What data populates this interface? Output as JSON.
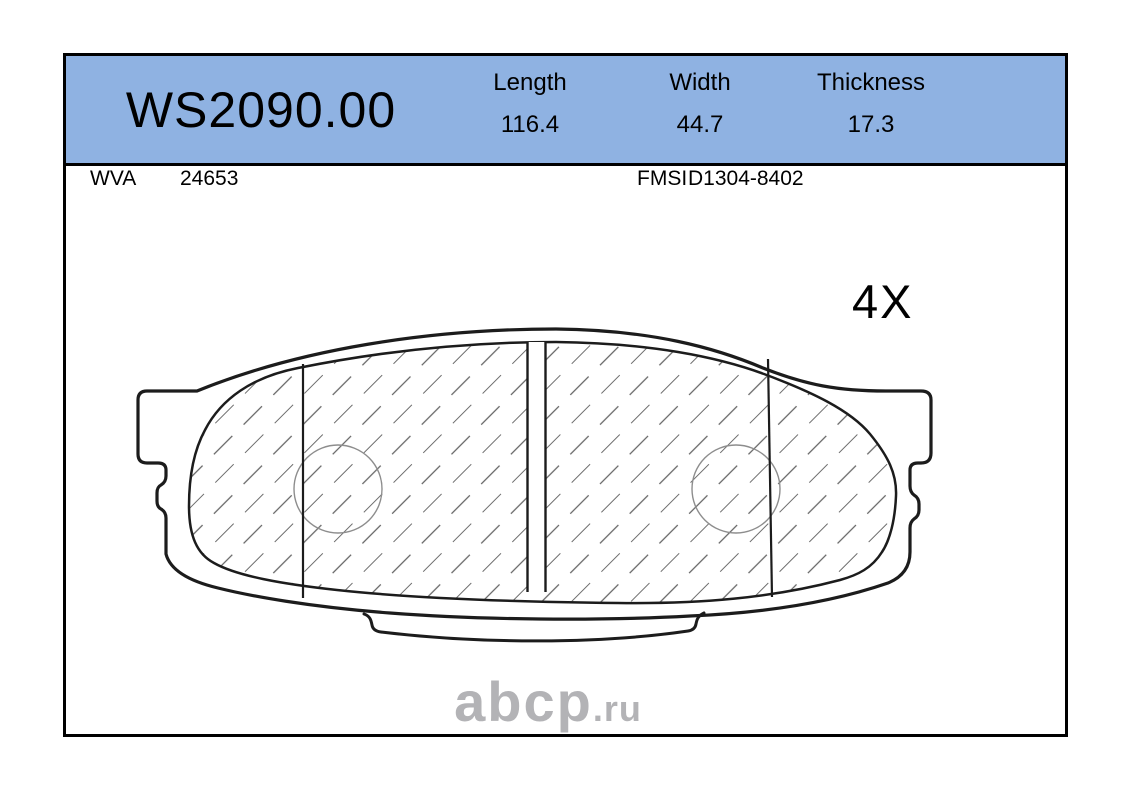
{
  "header": {
    "part_number": "WS2090.00",
    "bg_color": "#8FB2E2",
    "columns": [
      {
        "label": "Length",
        "value": "116.4"
      },
      {
        "label": "Width",
        "value": "44.7"
      },
      {
        "label": "Thickness",
        "value": "17.3"
      }
    ]
  },
  "subheader": {
    "wva": {
      "label": "WVA",
      "value": "24653"
    },
    "fmsi": {
      "label": "FMSI",
      "value": "D1304-8402"
    }
  },
  "drawing": {
    "quantity_label": "4X"
  },
  "watermark": {
    "name": "abcp",
    "tld": ".ru",
    "color": "#b3b3b6"
  }
}
